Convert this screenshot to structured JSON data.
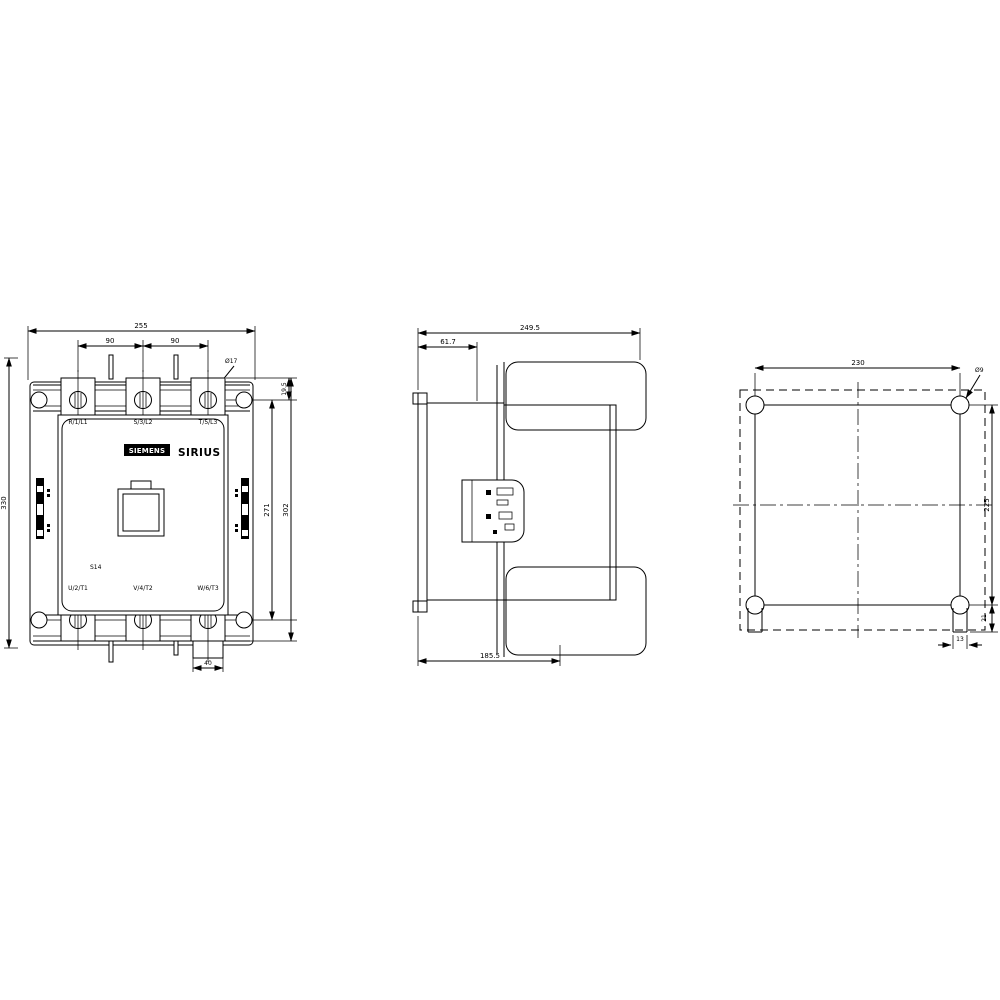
{
  "drawing": {
    "front": {
      "brand": "SIEMENS",
      "series": "SIRIUS",
      "size_label": "S14",
      "top_terminals": [
        "R/1/L1",
        "S/3/L2",
        "T/5/L3"
      ],
      "bottom_terminals": [
        "U/2/T1",
        "V/4/T2",
        "W/6/T3"
      ],
      "dims": {
        "overall_width": "255",
        "pole_pitch_left": "90",
        "pole_pitch_right": "90",
        "terminal_hole": "Ø17",
        "hole_offset": "19.5",
        "overall_height": "330",
        "mount_height_inner": "271",
        "mount_height_outer": "302",
        "lug_width": "40"
      }
    },
    "side": {
      "dims": {
        "overall_depth": "249.5",
        "front_offset": "61.7",
        "lower_depth": "185.5"
      }
    },
    "mounting": {
      "dims": {
        "hole_spacing_horizontal": "230",
        "hole_spacing_vertical": "225",
        "mounting_hole": "Ø9",
        "slot_offset": "21",
        "slot_width": "13"
      }
    },
    "colors": {
      "line": "#000000",
      "background": "#ffffff"
    }
  }
}
